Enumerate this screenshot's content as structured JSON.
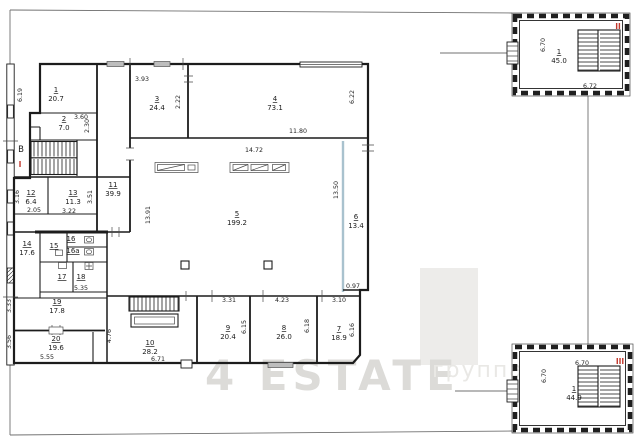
{
  "watermark": {
    "text": "4 ESTATE",
    "suffix": "группа"
  },
  "sections": {
    "main": "I",
    "upper": "II",
    "lower": "III"
  },
  "stair_letter": "В",
  "rooms": [
    {
      "num": "1",
      "area": "20.7"
    },
    {
      "num": "2",
      "area": "7.0"
    },
    {
      "num": "3",
      "area": "24.4"
    },
    {
      "num": "4",
      "area": "73.1"
    },
    {
      "num": "5",
      "area": "199.2"
    },
    {
      "num": "6",
      "area": "13.4"
    },
    {
      "num": "7",
      "area": "18.9"
    },
    {
      "num": "8",
      "area": "26.0"
    },
    {
      "num": "9",
      "area": "20.4"
    },
    {
      "num": "10",
      "area": "28.2"
    },
    {
      "num": "11",
      "area": "39.9"
    },
    {
      "num": "12",
      "area": "6.4"
    },
    {
      "num": "13",
      "area": "11.3"
    },
    {
      "num": "14",
      "area": "17.6"
    },
    {
      "num": "15",
      "area": ""
    },
    {
      "num": "16",
      "area": ""
    },
    {
      "num": "16а",
      "area": ""
    },
    {
      "num": "17",
      "area": ""
    },
    {
      "num": "18",
      "area": ""
    },
    {
      "num": "19",
      "area": "17.8"
    },
    {
      "num": "20",
      "area": "19.6"
    }
  ],
  "satellites": {
    "upper": {
      "num": "1",
      "area": "45.0"
    },
    "lower": {
      "num": "1",
      "area": "44.9"
    }
  },
  "dims": {
    "room1_height": "6.19",
    "room2_width": "3.60",
    "room2_height": "2.30",
    "room3_width": "3.93",
    "room3_height": "2.22",
    "room4_width": "11.80",
    "room4_height": "6.22",
    "hall_width": "14.72",
    "hall_height_left": "13.91",
    "hall_height_right": "13.50",
    "room6_bottom_width": "0.97",
    "room7_width": "3.10",
    "room7_height": "6.16",
    "room8_width": "4.23",
    "room8_height": "6.18",
    "room9_width": "3.31",
    "room9_height": "6.15",
    "room10_width": "6.71",
    "room10_height": "4.76",
    "room12_height": "3.16",
    "room12_width": "2.05",
    "room13_width": "3.22",
    "room13_height": "3.51",
    "block15_width": "5.35",
    "room19_height": "3.33",
    "room20_width": "5.55",
    "room20_height": "3.56",
    "bldg2_height": "6.70",
    "bldg2_width": "6.72",
    "bldg3_height": "6.70",
    "bldg3_width": "6.70"
  }
}
